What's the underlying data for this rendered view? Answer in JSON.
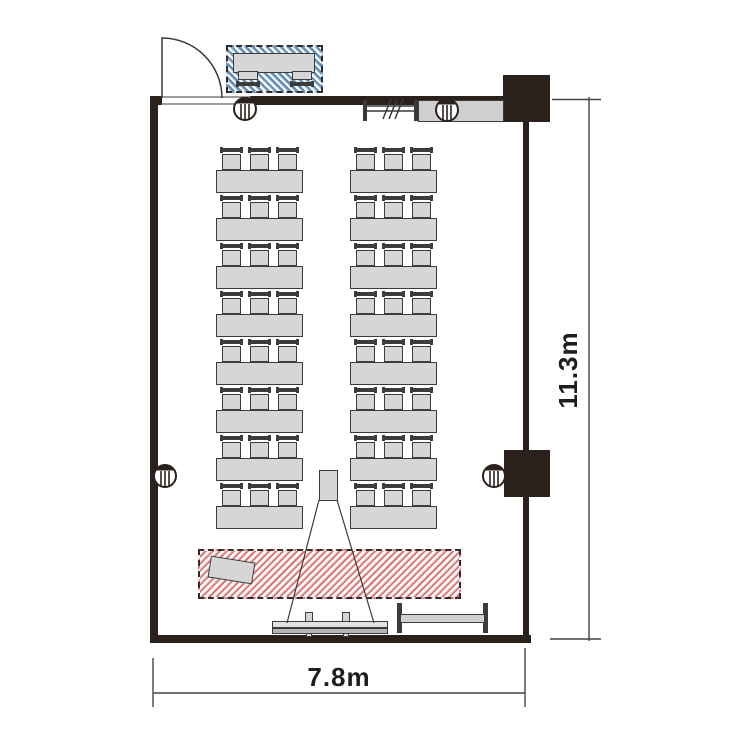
{
  "diagram": {
    "type": "floor-plan",
    "width_label": "7.8m",
    "height_label": "11.3m"
  },
  "seating": {
    "columns_x": [
      216,
      350
    ],
    "rows_y": [
      170,
      218,
      266,
      314,
      362,
      410,
      458,
      506
    ],
    "table": {
      "width": 87,
      "height": 23
    },
    "chair": {
      "width": 21,
      "height": 22,
      "offsets": [
        5,
        33,
        61
      ]
    },
    "tables_total": 16,
    "chairs_per_table": 3,
    "seats_total": 48
  },
  "elements": {
    "door": "outward-swing door (top-left)",
    "reception_zone": "blue hatched zone with desk and 2 chairs",
    "reception_desk": "reception desk",
    "service_counter": "counter on top wall",
    "partition_track": "movable partition break symbol",
    "pillars": [
      {
        "x": 245,
        "y": 109
      },
      {
        "x": 447,
        "y": 110
      },
      {
        "x": 165,
        "y": 476
      },
      {
        "x": 494,
        "y": 476
      }
    ],
    "structural_columns": 2,
    "projector": "projector on stand with beam",
    "screen": "projection screen at front wall",
    "stage_zone": "red hatched presentation zone",
    "lectern": "tilted lectern",
    "whiteboard": "mobile whiteboard (bottom-right)"
  },
  "colors": {
    "wall": "#2a211d",
    "furniture": "#d6d6d6",
    "counter": "#cfcfcf",
    "outline": "#3c3c3c",
    "hatchBlue": "#5f8cb4",
    "hatchBlueLight": "#a7c0d6",
    "hatchRed": "#d97070",
    "hatchRedLight": "#efb3b3",
    "dashBorder": "#332b27",
    "dimLine": "#444444",
    "text": "#1e1e1e"
  }
}
